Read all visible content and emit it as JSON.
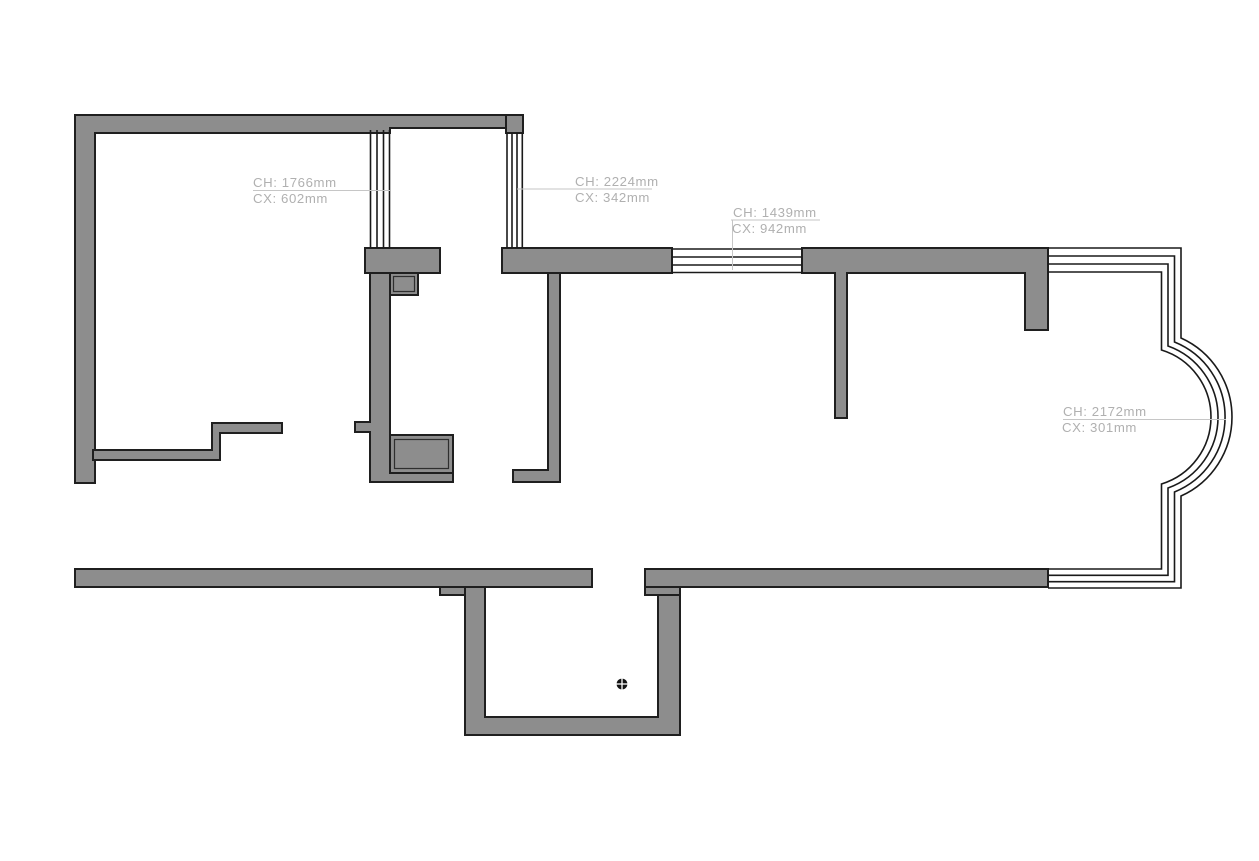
{
  "canvas": {
    "background": "#ffffff"
  },
  "colors": {
    "wall_fill": "#8d8d8d",
    "wall_stroke": "#1f1f1f",
    "window_stroke": "#1a1a1a",
    "leader_line": "#c6c6c6",
    "label_text": "#b0b0b0",
    "drain_fill": "#141414"
  },
  "dimension_labels": [
    {
      "name": "left-window",
      "ch": "CH: 1766mm",
      "cx": "CX: 602mm"
    },
    {
      "name": "small-room-window",
      "ch": "CH: 2224mm",
      "cx": "CX: 342mm"
    },
    {
      "name": "center-window",
      "ch": "CH: 1439mm",
      "cx": "CX: 942mm"
    },
    {
      "name": "bay-window",
      "ch": "CH: 2172mm",
      "cx": "CX: 301mm"
    }
  ],
  "symbols": [
    {
      "name": "floor-drain"
    }
  ]
}
